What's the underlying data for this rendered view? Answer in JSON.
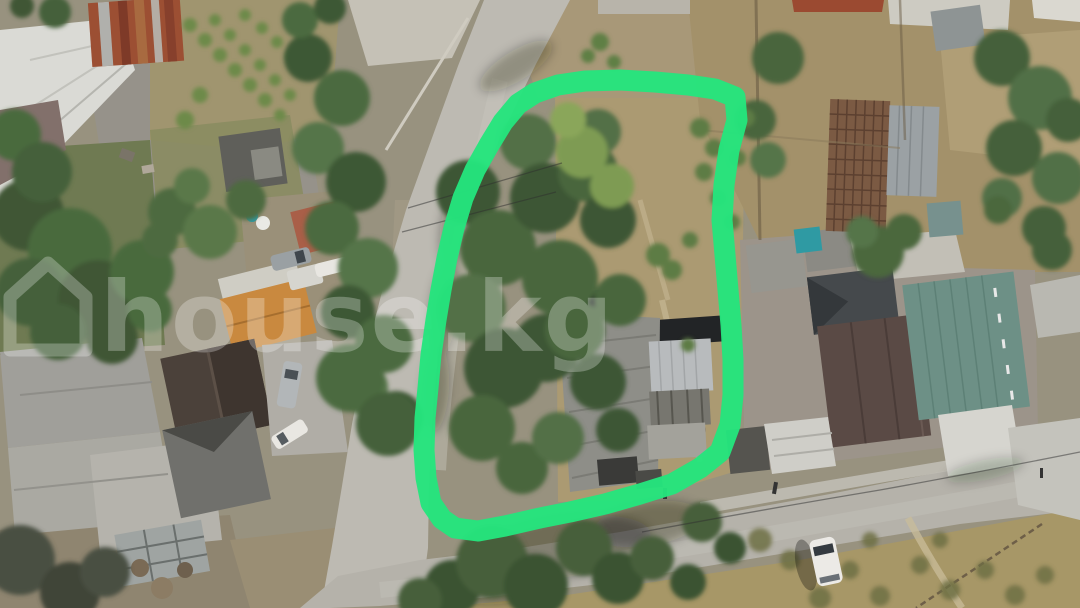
{
  "watermark": {
    "text": "house.kg",
    "icon": "house-outline",
    "color": "#ffffff",
    "opacity": 0.27
  },
  "boundary_annotation": {
    "shape": "freehand-loop",
    "color": "#24e57d",
    "stroke_width": 21
  },
  "palette": {
    "road": "#bdbab2",
    "road_lower": "#b5b2aa",
    "dirt_field": "#a3916a",
    "dry_grass": "#a79767",
    "inside_dirt": "#ab9a72",
    "tree_dark": "#3f5636",
    "tree_mid": "#4b6b3f",
    "tree_light": "#7e9b52",
    "roof_white": "#dadad5",
    "roof_rust": "#9c4f33",
    "roof_orange": "#c9893f",
    "roof_dark_brown": "#4b413a",
    "roof_brown": "#5a4a45",
    "roof_green_metal": "#6d9086",
    "roof_charcoal": "#45494c",
    "roof_gray": "#9b9a94",
    "roof_tile_grid": "#7b5a43",
    "pool_teal": "#2f9aa3",
    "car_white": "#eceae6"
  }
}
